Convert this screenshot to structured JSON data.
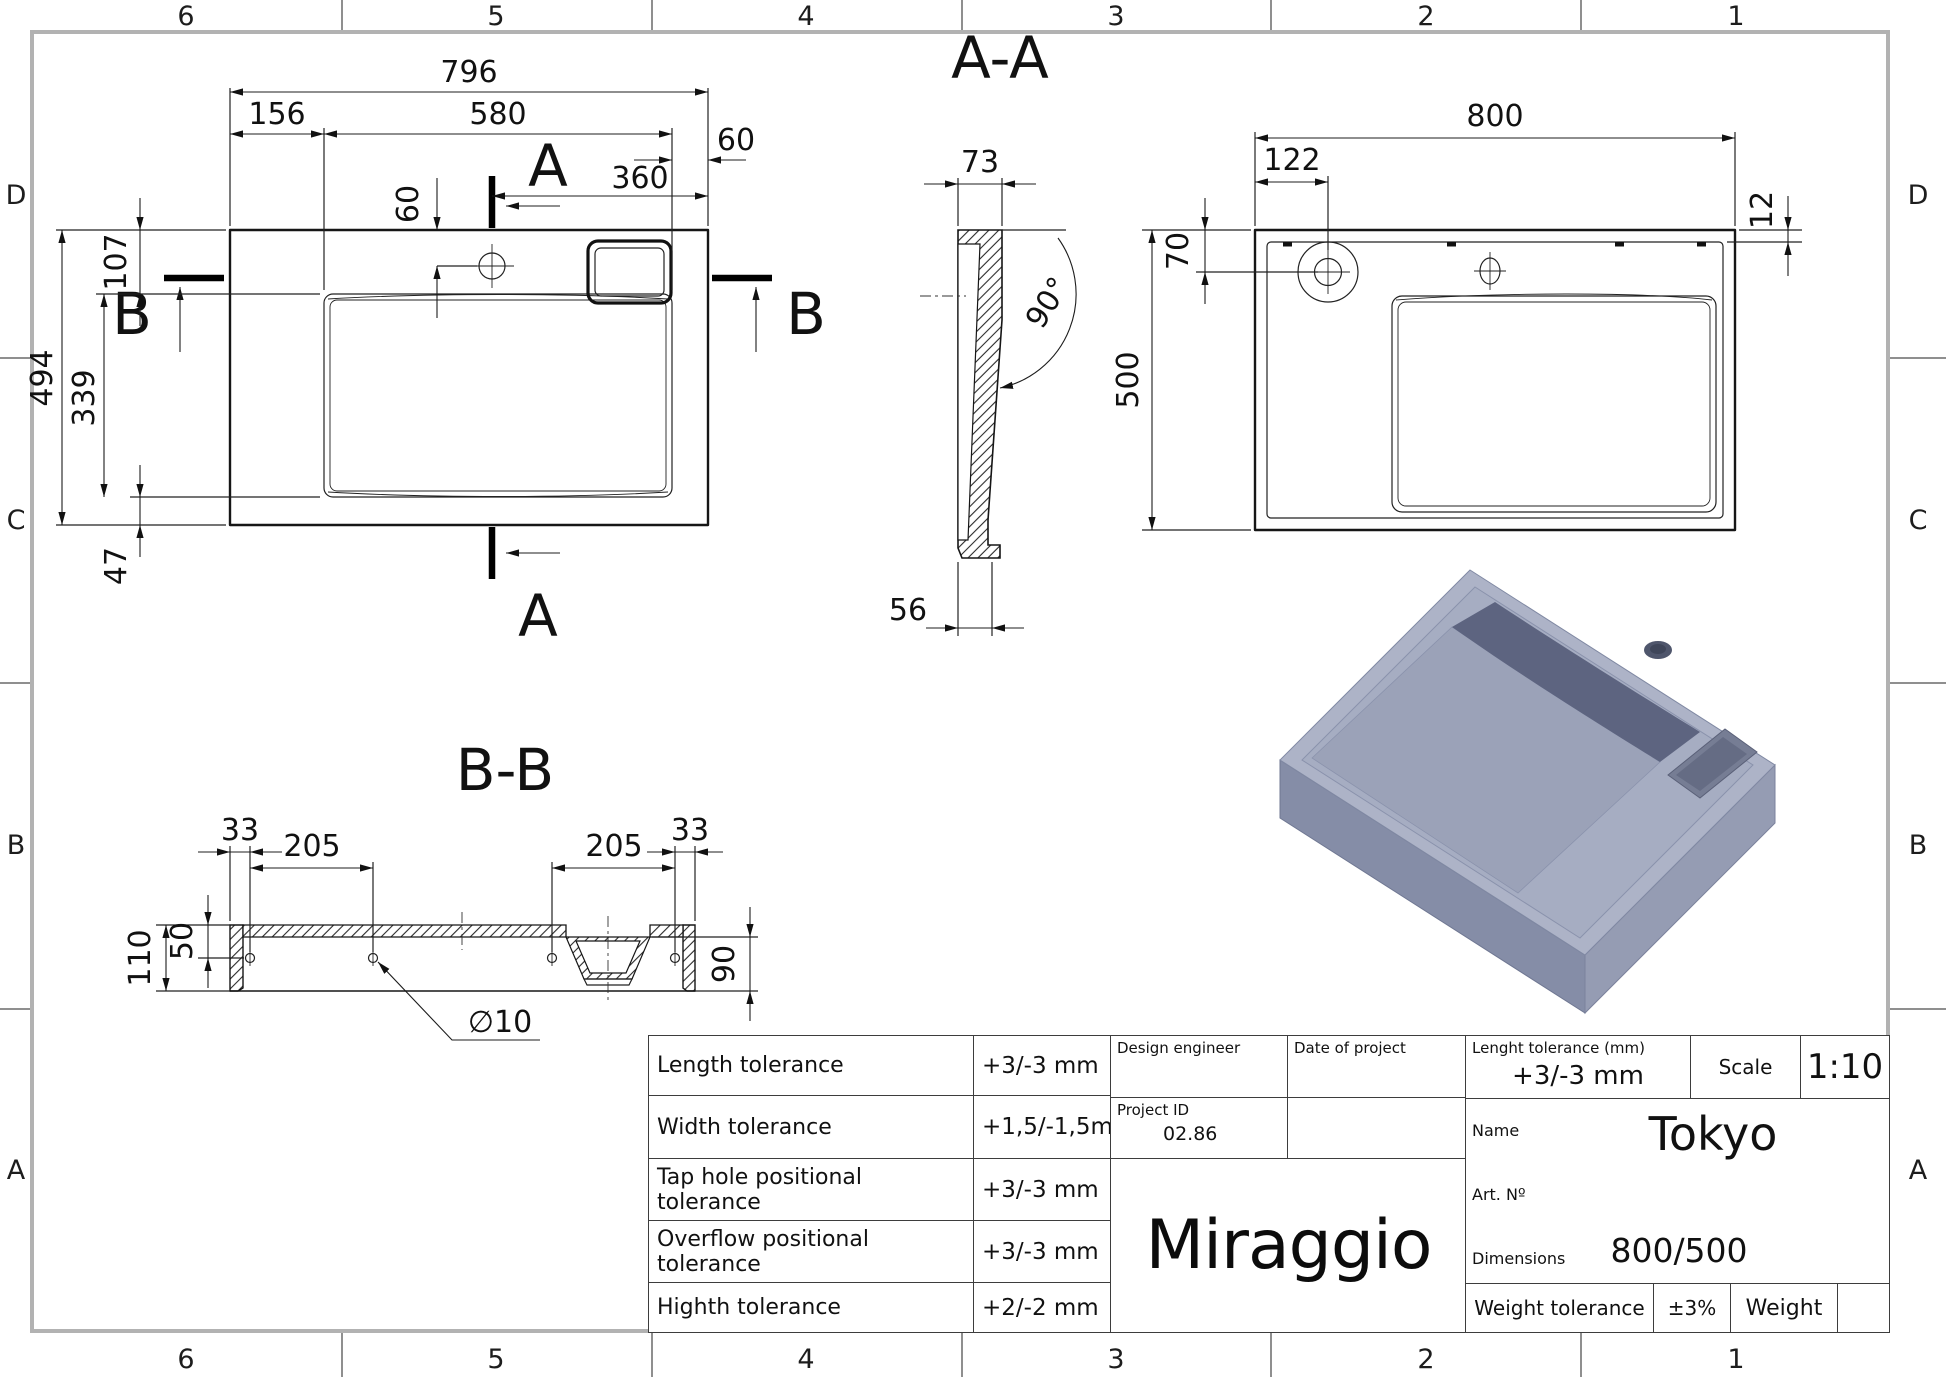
{
  "sheet": {
    "cols": [
      "6",
      "5",
      "4",
      "3",
      "2",
      "1"
    ],
    "rows": [
      "D",
      "C",
      "B",
      "A"
    ]
  },
  "views": {
    "plan": {
      "dim_total_width": "796",
      "dim_left_offset": "156",
      "dim_basin_width": "580",
      "dim_right_offset": "60",
      "dim_tap_from_top": "60",
      "dim_tap_from_right": "360",
      "dim_total_depth": "494",
      "dim_top_offset": "107",
      "dim_basin_depth": "339",
      "dim_bottom_offset": "47",
      "section_a": "A",
      "section_b": "B"
    },
    "section_aa": {
      "title": "A-A",
      "dim_wall": "73",
      "dim_angle": "90°",
      "dim_foot": "56"
    },
    "view_bottom": {
      "dim_width": "800",
      "dim_tap_offset": "122",
      "dim_tap_depth": "70",
      "dim_rim": "12",
      "dim_depth": "500"
    },
    "section_bb": {
      "title": "B-B",
      "dim_edge_left": "33",
      "dim_span_left": "205",
      "dim_hole_depth": "50",
      "dim_height": "110",
      "dim_span_right": "205",
      "dim_edge_right": "33",
      "dim_drain_depth": "90",
      "dim_hole_diameter": "∅10"
    }
  },
  "title_block": {
    "tolerances": [
      {
        "label": "Length tolerance",
        "value": "+3/-3 mm"
      },
      {
        "label": "Width tolerance",
        "value": "+1,5/-1,5mm"
      },
      {
        "label": "Tap hole positional tolerance",
        "value": "+3/-3 mm"
      },
      {
        "label": "Overflow positional tolerance",
        "value": "+3/-3 mm"
      },
      {
        "label": "Highth tolerance",
        "value": "+2/-2 mm"
      }
    ],
    "design_engineer_label": "Design engineer",
    "date_of_project_label": "Date of project",
    "project_id_label": "Project ID",
    "project_id_value": "02.86",
    "brand": "Miraggio",
    "length_tolerance_label": "Lenght tolerance (mm)",
    "length_tolerance_value": "+3/-3 mm",
    "scale_label": "Scale",
    "scale_value": "1:10",
    "name_label": "Name",
    "name_value": "Tokyo",
    "art_no_label": "Art. Nº",
    "dimensions_label": "Dimensions",
    "dimensions_value": "800/500",
    "weight_tolerance_label": "Weight tolerance",
    "weight_tolerance_value": "±3%",
    "weight_label": "Weight"
  },
  "colors": {
    "line": "#1a1a1a",
    "frame": "#b2b2b2",
    "render_body": "#a9b0c5",
    "render_shadow": "#5d6480"
  }
}
